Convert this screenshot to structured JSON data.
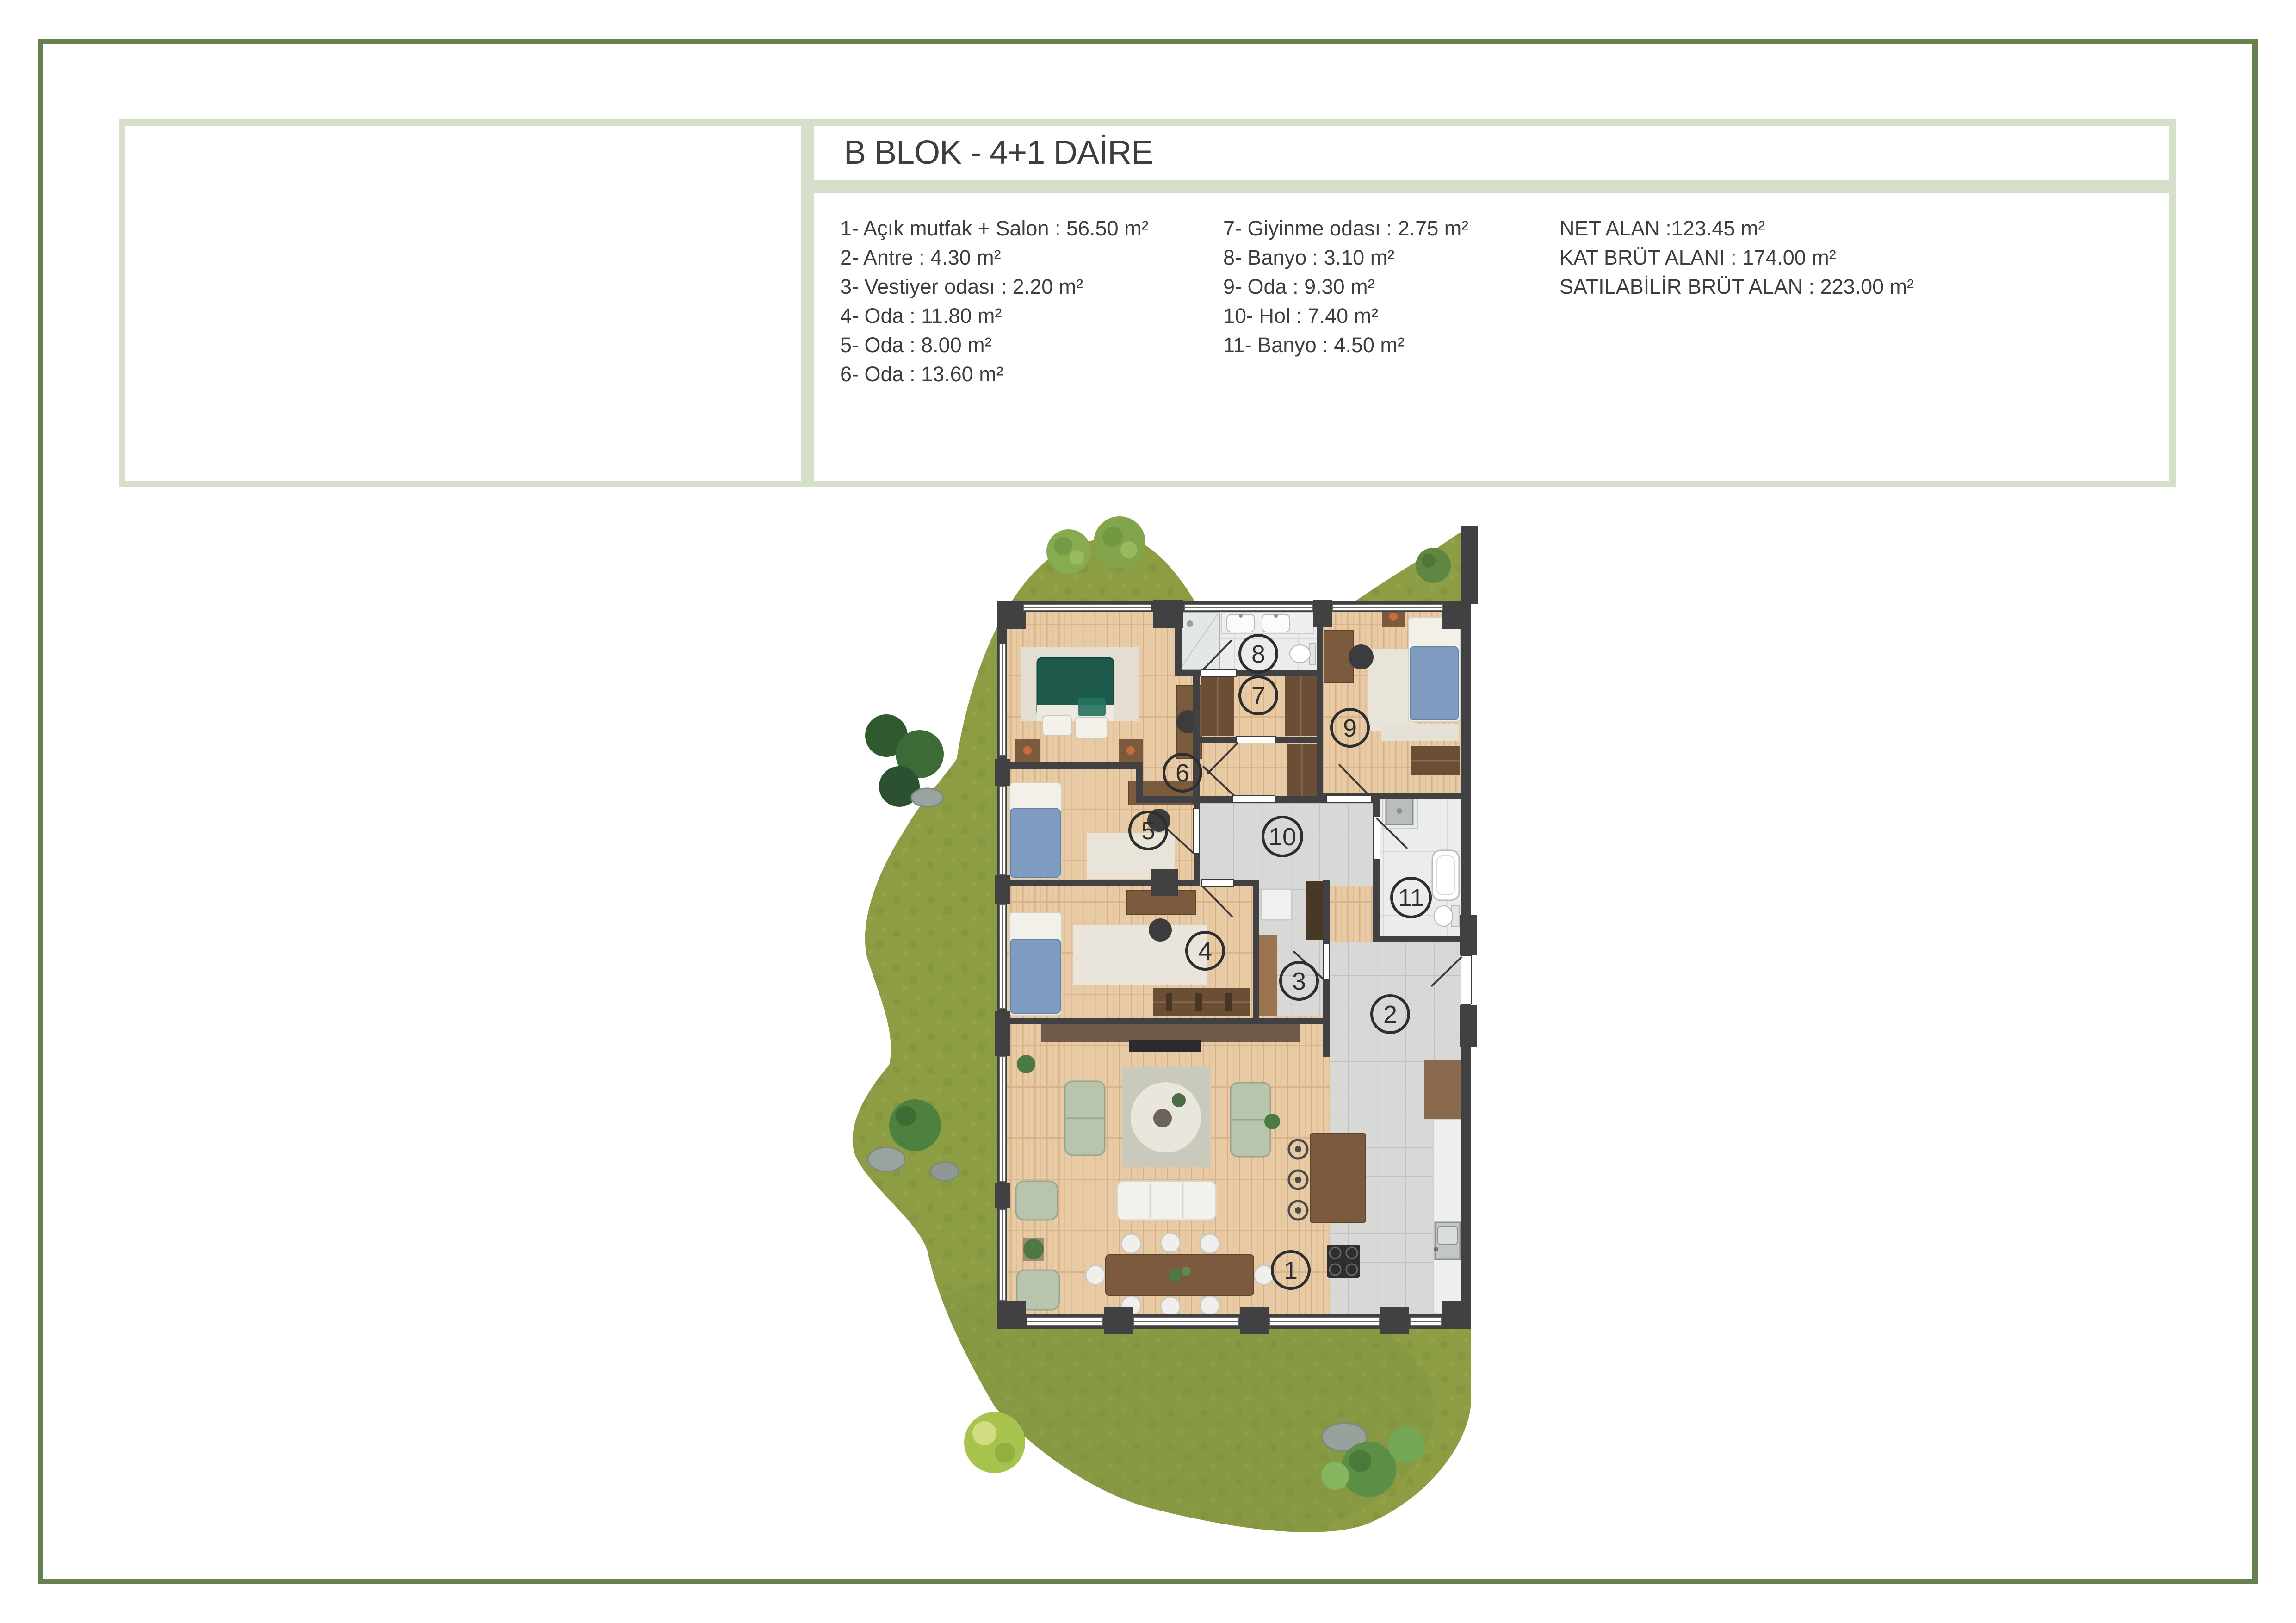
{
  "header": {
    "title": "B BLOK - 4+1 DAİRE"
  },
  "legend": {
    "col1": [
      "1- Açık mutfak + Salon : 56.50 m²",
      "2- Antre : 4.30 m²",
      "3- Vestiyer odası : 2.20 m²",
      "4- Oda : 11.80 m²",
      "5- Oda : 8.00 m²",
      "6- Oda : 13.60 m²"
    ],
    "col2": [
      "7- Giyinme odası : 2.75 m²",
      "8- Banyo : 3.10 m²",
      "9- Oda : 9.30 m²",
      "10- Hol : 7.40 m²",
      "11- Banyo : 4.50 m²"
    ],
    "summary": [
      "NET ALAN :123.45 m²",
      "KAT BRÜT ALANI : 174.00 m²",
      "SATILABİLİR BRÜT ALAN : 223.00 m²"
    ]
  },
  "plan": {
    "room_labels": [
      "1",
      "2",
      "3",
      "4",
      "5",
      "6",
      "7",
      "8",
      "9",
      "10",
      "11"
    ]
  },
  "colors": {
    "frame_green": "#66804f",
    "box_border": "#d5dfc9",
    "grass": "#8c9d44",
    "wall": "#414143",
    "wood_floor": "#e8cba4",
    "tile_floor": "#d9dad8",
    "bed_green": "#1e5a4c",
    "bed_blue": "#7f9cc0",
    "sofa_sage": "#b9c4ad"
  }
}
